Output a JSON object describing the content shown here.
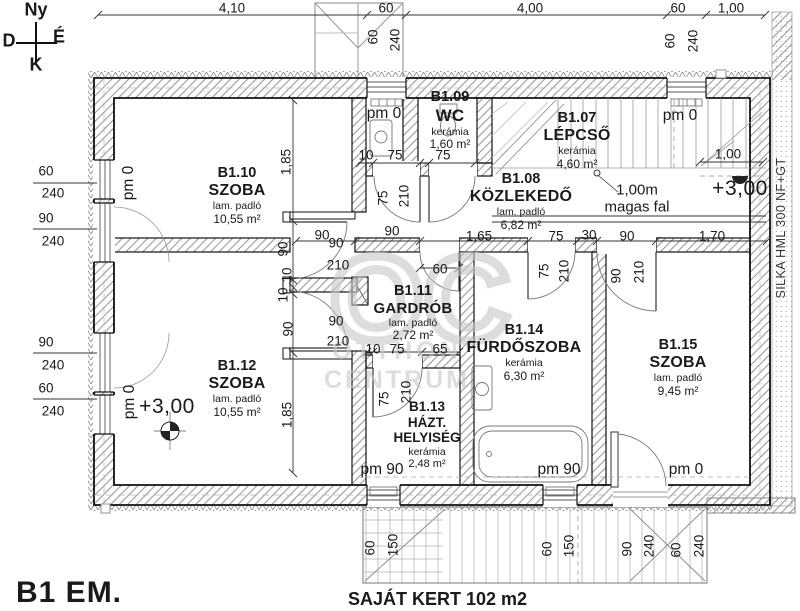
{
  "title": "B1 EM.",
  "garden_note": "SAJÁT KERT 102 m2",
  "compass": {
    "top": "Ny",
    "left": "D",
    "right": "É",
    "bottom": "K"
  },
  "watermark": {
    "logo": "OC",
    "line1": "OTTHON",
    "line2": "CENTRUM"
  },
  "rooms": {
    "b107": {
      "id": "B1.07",
      "name": "LÉPCSŐ",
      "floor": "kerámia",
      "area": "4,60 m²"
    },
    "b108": {
      "id": "B1.08",
      "name": "KÖZLEKEDŐ",
      "floor": "lam. padló",
      "area": "6,82 m²"
    },
    "b109": {
      "id": "B1.09",
      "name": "WC",
      "floor": "kerámia",
      "area": "1,60 m²"
    },
    "b110": {
      "id": "B1.10",
      "name": "SZOBA",
      "floor": "lam. padló",
      "area": "10,55 m²"
    },
    "b111": {
      "id": "B1.11",
      "name": "GARDRÓB",
      "floor": "lam. padló",
      "area": "2,72 m²"
    },
    "b112": {
      "id": "B1.12",
      "name": "SZOBA",
      "floor": "lam. padló",
      "area": "10,55 m²"
    },
    "b113": {
      "id": "B1.13",
      "name": "HÁZT. HELYISÉG",
      "floor": "kerámia",
      "area": "2,48 m²"
    },
    "b114": {
      "id": "B1.14",
      "name": "FÜRDŐSZOBA",
      "floor": "kerámia",
      "area": "6,30 m²"
    },
    "b115": {
      "id": "B1.15",
      "name": "SZOBA",
      "floor": "lam. padló",
      "area": "9,45 m²"
    }
  },
  "annotations": [
    {
      "t": "Ny",
      "x": 36,
      "y": 10,
      "c": "cmp",
      "n": "compass-label-top"
    },
    {
      "t": "D",
      "x": 9,
      "y": 41,
      "c": "cmp",
      "n": "compass-label-left"
    },
    {
      "t": "É",
      "x": 59,
      "y": 37,
      "c": "cmp",
      "n": "compass-label-right"
    },
    {
      "t": "K",
      "x": 36,
      "y": 65,
      "c": "cmp",
      "n": "compass-label-bottom"
    },
    {
      "t": "4,10",
      "x": 232,
      "y": 8
    },
    {
      "t": "60",
      "x": 386,
      "y": 8
    },
    {
      "t": "4,00",
      "x": 530,
      "y": 8
    },
    {
      "t": "60",
      "x": 678,
      "y": 8
    },
    {
      "t": "1,00",
      "x": 731,
      "y": 8
    },
    {
      "t": "60",
      "x": 373,
      "y": 37,
      "r": -90
    },
    {
      "t": "240",
      "x": 395,
      "y": 40,
      "r": -90
    },
    {
      "t": "60",
      "x": 670,
      "y": 41,
      "r": -90
    },
    {
      "t": "240",
      "x": 693,
      "y": 41,
      "r": -90
    },
    {
      "t": "60",
      "x": 46,
      "y": 171
    },
    {
      "t": "240",
      "x": 53,
      "y": 193
    },
    {
      "t": "90",
      "x": 46,
      "y": 218
    },
    {
      "t": "240",
      "x": 53,
      "y": 241
    },
    {
      "t": "90",
      "x": 46,
      "y": 342
    },
    {
      "t": "240",
      "x": 53,
      "y": 365
    },
    {
      "t": "60",
      "x": 46,
      "y": 388
    },
    {
      "t": "240",
      "x": 53,
      "y": 411
    },
    {
      "t": "pm 0",
      "x": 384,
      "y": 114,
      "c": "pm",
      "n": "parapet-label"
    },
    {
      "t": "pm 0",
      "x": 680,
      "y": 116,
      "c": "pm",
      "n": "parapet-label"
    },
    {
      "t": "pm 0",
      "x": 129,
      "y": 183,
      "r": -90,
      "c": "pm",
      "n": "parapet-label"
    },
    {
      "t": "pm 0",
      "x": 130,
      "y": 402,
      "r": -90,
      "c": "pm",
      "n": "parapet-label"
    },
    {
      "t": "pm 90",
      "x": 382,
      "y": 470,
      "c": "pm",
      "n": "parapet-label"
    },
    {
      "t": "pm 90",
      "x": 559,
      "y": 470,
      "c": "pm",
      "n": "parapet-label"
    },
    {
      "t": "pm 0",
      "x": 686,
      "y": 470,
      "c": "pm",
      "n": "parapet-label"
    },
    {
      "t": "10",
      "x": 366,
      "y": 155
    },
    {
      "t": "75",
      "x": 395,
      "y": 155
    },
    {
      "t": "75",
      "x": 443,
      "y": 155
    },
    {
      "t": "75",
      "x": 383,
      "y": 198,
      "r": -90
    },
    {
      "t": "210",
      "x": 404,
      "y": 196,
      "r": -90
    },
    {
      "t": "90",
      "x": 392,
      "y": 231
    },
    {
      "t": "90",
      "x": 322,
      "y": 235
    },
    {
      "t": "1,65",
      "x": 479,
      "y": 236
    },
    {
      "t": "75",
      "x": 556,
      "y": 236
    },
    {
      "t": "30",
      "x": 589,
      "y": 235
    },
    {
      "t": "90",
      "x": 627,
      "y": 236
    },
    {
      "t": "1,70",
      "x": 712,
      "y": 236
    },
    {
      "t": "75",
      "x": 544,
      "y": 271,
      "r": -90
    },
    {
      "t": "210",
      "x": 564,
      "y": 271,
      "r": -90
    },
    {
      "t": "90",
      "x": 616,
      "y": 276,
      "r": -90
    },
    {
      "t": "210",
      "x": 639,
      "y": 272,
      "r": -90
    },
    {
      "t": "90",
      "x": 336,
      "y": 243
    },
    {
      "t": "210",
      "x": 338,
      "y": 265
    },
    {
      "t": "90",
      "x": 336,
      "y": 321
    },
    {
      "t": "210",
      "x": 338,
      "y": 341
    },
    {
      "t": "90",
      "x": 283,
      "y": 249,
      "r": -90
    },
    {
      "t": "10",
      "x": 287,
      "y": 275,
      "r": -90
    },
    {
      "t": "10",
      "x": 283,
      "y": 295,
      "r": -90
    },
    {
      "t": "90",
      "x": 288,
      "y": 329,
      "r": -90
    },
    {
      "t": "1,85",
      "x": 286,
      "y": 162,
      "r": -90
    },
    {
      "t": "1,85",
      "x": 287,
      "y": 415,
      "r": -90
    },
    {
      "t": "60",
      "x": 440,
      "y": 269
    },
    {
      "t": "10",
      "x": 373,
      "y": 349
    },
    {
      "t": "75",
      "x": 397,
      "y": 349
    },
    {
      "t": "65",
      "x": 440,
      "y": 349
    },
    {
      "t": "75",
      "x": 384,
      "y": 399,
      "r": -90
    },
    {
      "t": "210",
      "x": 406,
      "y": 392,
      "r": -90
    },
    {
      "t": "1,00",
      "x": 728,
      "y": 154
    },
    {
      "t": "+3,00",
      "x": 740,
      "y": 189,
      "c": "big",
      "n": "level-label"
    },
    {
      "t": "1,00m",
      "x": 637,
      "y": 190,
      "c": "mid",
      "n": "wall-height-note"
    },
    {
      "t": "magas fal",
      "x": 637,
      "y": 207,
      "c": "mid",
      "n": "wall-height-note"
    },
    {
      "t": "+3,00",
      "x": 167,
      "y": 407,
      "c": "big",
      "n": "level-label"
    },
    {
      "t": "60",
      "x": 370,
      "y": 548,
      "r": -90
    },
    {
      "t": "150",
      "x": 393,
      "y": 545,
      "r": -90
    },
    {
      "t": "60",
      "x": 547,
      "y": 549,
      "r": -90
    },
    {
      "t": "150",
      "x": 569,
      "y": 546,
      "r": -90
    },
    {
      "t": "90",
      "x": 627,
      "y": 549,
      "r": -90
    },
    {
      "t": "240",
      "x": 649,
      "y": 546,
      "r": -90
    },
    {
      "t": "60",
      "x": 676,
      "y": 550,
      "r": -90
    },
    {
      "t": "240",
      "x": 699,
      "y": 546,
      "r": -90
    },
    {
      "t": "SILKA HML 300 NF+GT",
      "x": 781,
      "y": 228,
      "r": -90,
      "c": "silka",
      "n": "wall-material-note"
    }
  ]
}
